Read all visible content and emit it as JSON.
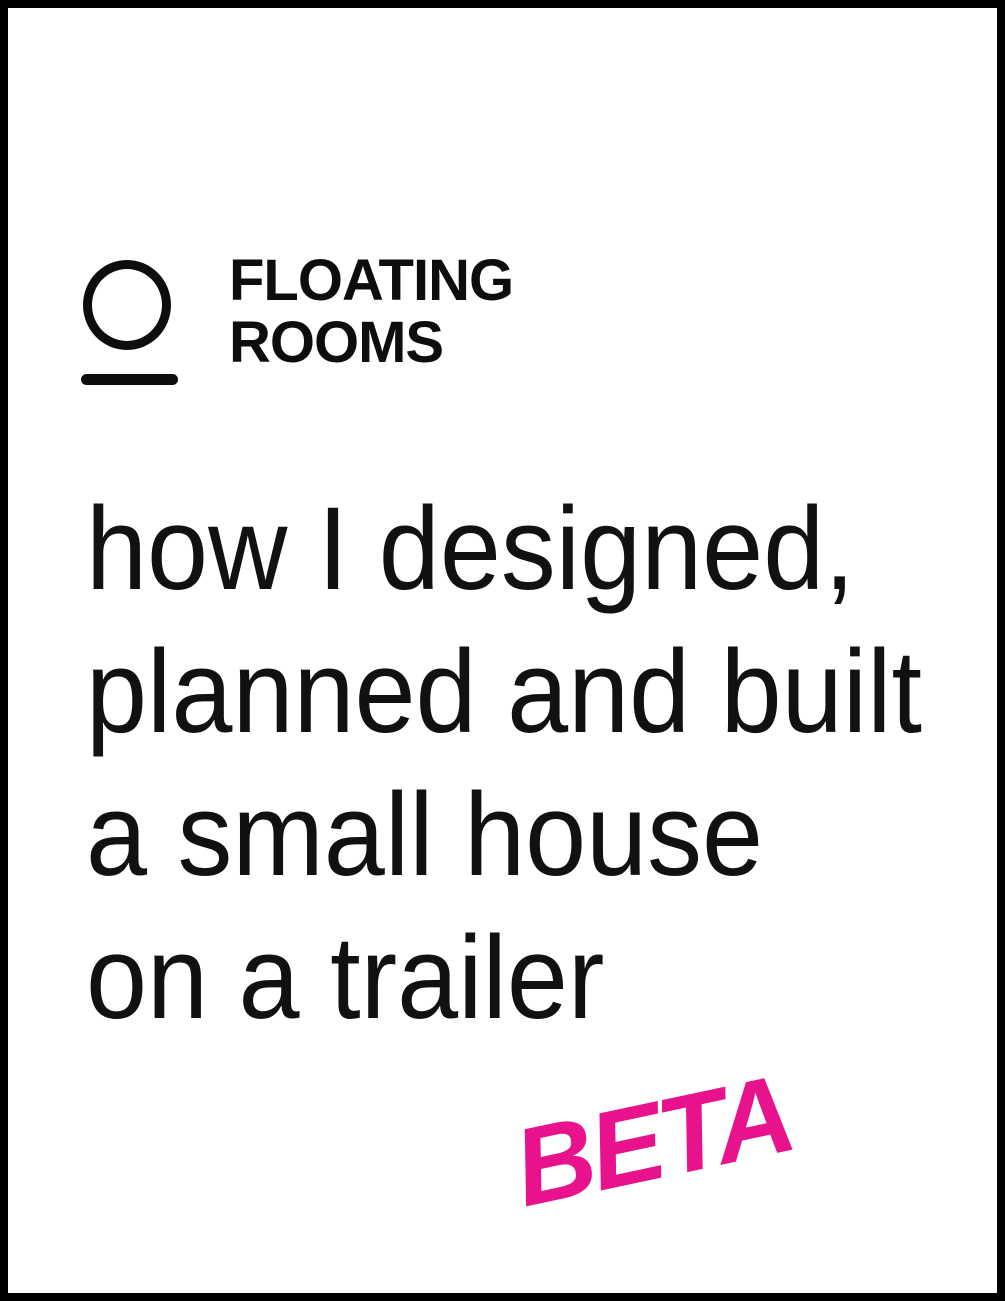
{
  "page": {
    "background_color": "#ffffff",
    "border_color": "#000000"
  },
  "logo": {
    "mark": "circle-over-line",
    "color": "#0d0d0d",
    "name_line1": "FLOATING",
    "name_line2": "ROOMS"
  },
  "headline": {
    "color": "#111111",
    "lines": [
      "how I designed,",
      "planned and built",
      "a small house",
      "on a trailer"
    ]
  },
  "beta_badge": {
    "label": "BETA",
    "color": "#e8128c"
  }
}
